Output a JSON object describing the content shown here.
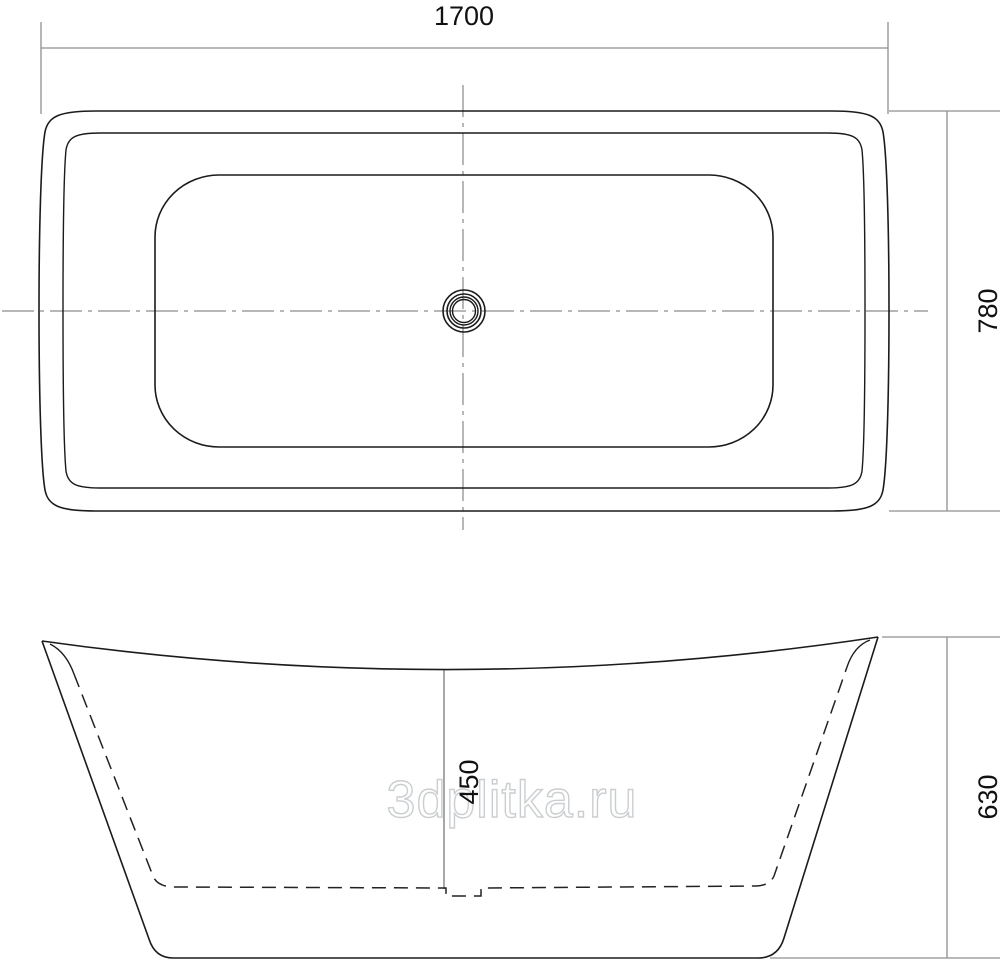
{
  "drawing": {
    "subject": "bathtub-two-view-dimension-drawing",
    "dimensions": {
      "length": {
        "label": "1700"
      },
      "width": {
        "label": "780"
      },
      "depth": {
        "label": "450"
      },
      "height": {
        "label": "630"
      }
    },
    "watermark": {
      "text": "3dplitka.ru"
    },
    "colors": {
      "outline": "#1b1b1b",
      "hidden_line": "#222222",
      "dimension_line": "#8f8f8f",
      "centerline": "#6f6f6f",
      "label_text": "#111111",
      "watermark_stroke": "#cbced0",
      "background": "#ffffff"
    }
  }
}
